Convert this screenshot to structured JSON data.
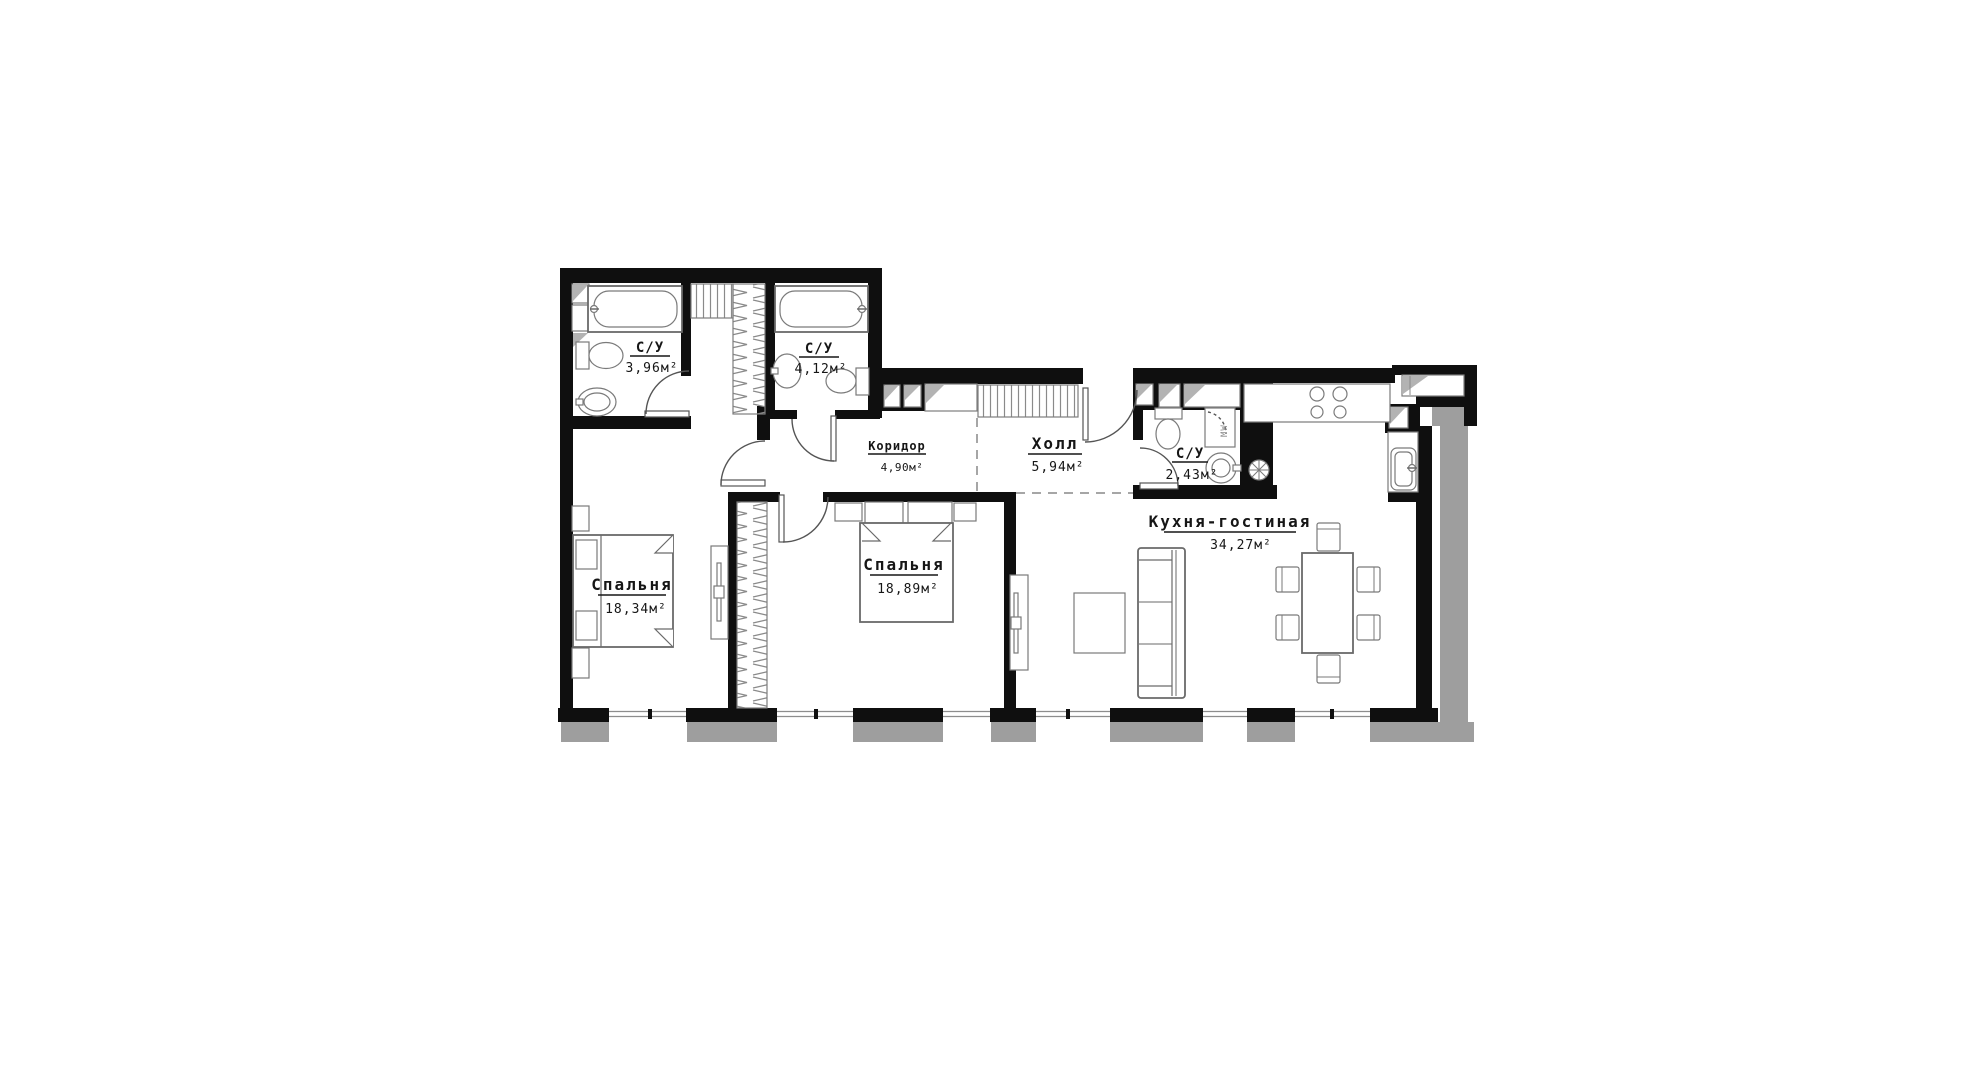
{
  "plan": {
    "type": "apartment-floor-plan",
    "rooms": [
      {
        "id": "bathroom-1",
        "name": "С/У",
        "area": "3,96м²"
      },
      {
        "id": "bathroom-2",
        "name": "С/У",
        "area": "4,12м²"
      },
      {
        "id": "corridor",
        "name": "Коридор",
        "area": "4,90м²"
      },
      {
        "id": "hall",
        "name": "Холл",
        "area": "5,94м²"
      },
      {
        "id": "bathroom-3",
        "name": "С/У",
        "area": "2,43м²"
      },
      {
        "id": "bedroom-1",
        "name": "Спальня",
        "area": "18,34м²"
      },
      {
        "id": "bedroom-2",
        "name": "Спальня",
        "area": "18,89м²"
      },
      {
        "id": "kitchen-living",
        "name": "Кухня-гостиная",
        "area": "34,27м²"
      }
    ],
    "appliances": {
      "washer_label": "MW"
    },
    "colors": {
      "wall": "#0f0f0f",
      "masonry": "#9e9e9e",
      "furniture_line": "#6a6a6a",
      "background": "#ffffff"
    }
  }
}
